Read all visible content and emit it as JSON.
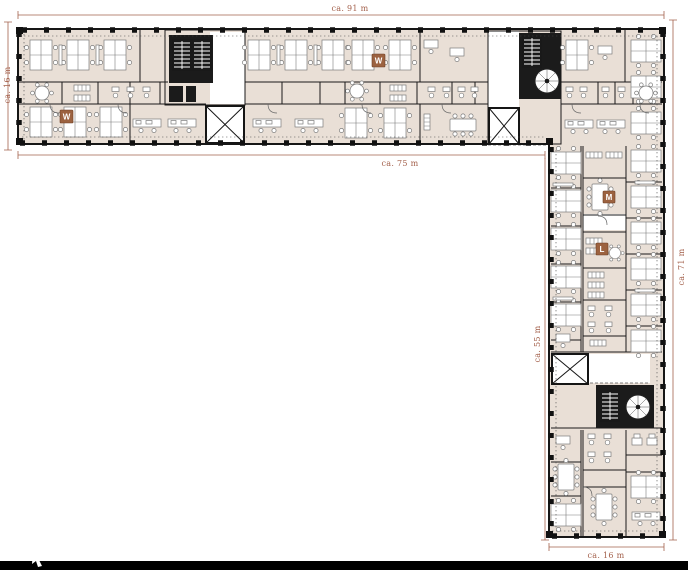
{
  "plan": {
    "dimension_labels": {
      "top_wing_width": "ca. 91 m",
      "top_wing_depth": "ca. 16 m",
      "top_wing_inner_width": "ca. 75 m",
      "right_wing_inner_height": "ca. 55 m",
      "right_wing_height": "ca. 71 m",
      "right_wing_width": "ca. 16 m"
    },
    "room_markers": [
      {
        "letter": "W"
      },
      {
        "letter": "W"
      },
      {
        "letter": "M"
      },
      {
        "letter": "L"
      }
    ],
    "colors": {
      "background": "#ffffff",
      "wall": "#1a1a1a",
      "floor": "#e9dfd6",
      "dimension": "#a4624d",
      "marker": "#9c6240",
      "furniture_line": "#7c7c7c",
      "bottom_bar": "#000000"
    }
  }
}
